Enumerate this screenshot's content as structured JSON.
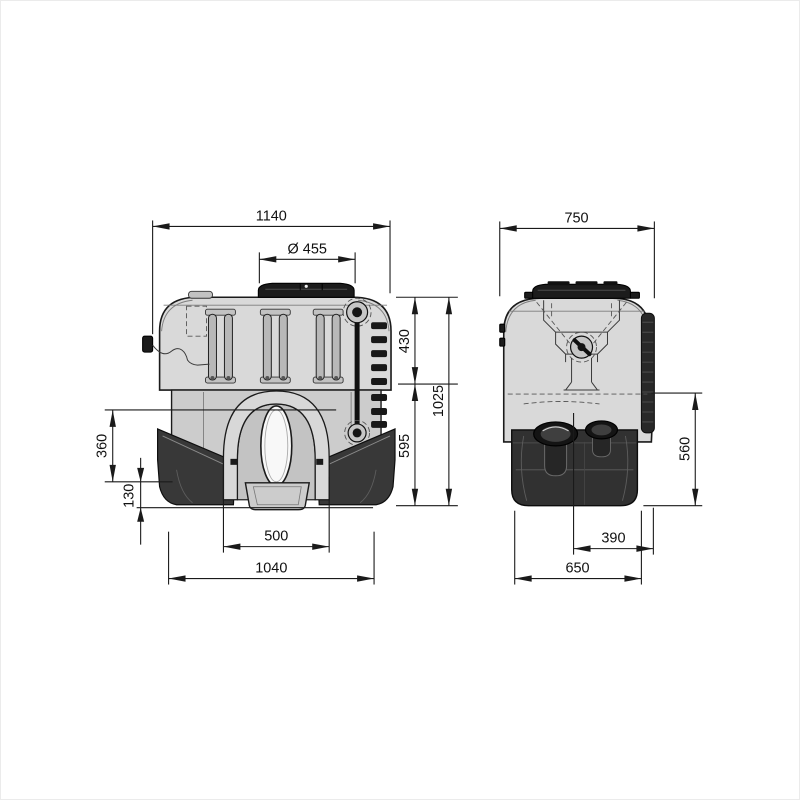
{
  "drawing_title": "tank-dimension-drawing",
  "colors": {
    "background": "#ffffff",
    "frame": "#ebebeb",
    "line": "#1a1a1a",
    "dim_text": "#111111",
    "tank_body": "#d9d9d9",
    "tank_panel": "#cccccc",
    "tank_recess": "#c3c3c3",
    "dark_plastic": "#1c1c1c",
    "base_dark": "#313131",
    "legs_dark": "#383838"
  },
  "front_view": {
    "dims": {
      "overall_width": "1140",
      "filler_diameter": "Ø 455",
      "upper_height": "430",
      "total_height": "1025",
      "lower_height": "595",
      "arch_top_offset": "360",
      "foot_height": "130",
      "arch_width": "500",
      "base_width": "1040"
    }
  },
  "side_view": {
    "dims": {
      "overall_depth": "750",
      "lower_height": "560",
      "outlet_offset": "390",
      "base_depth": "650"
    }
  }
}
